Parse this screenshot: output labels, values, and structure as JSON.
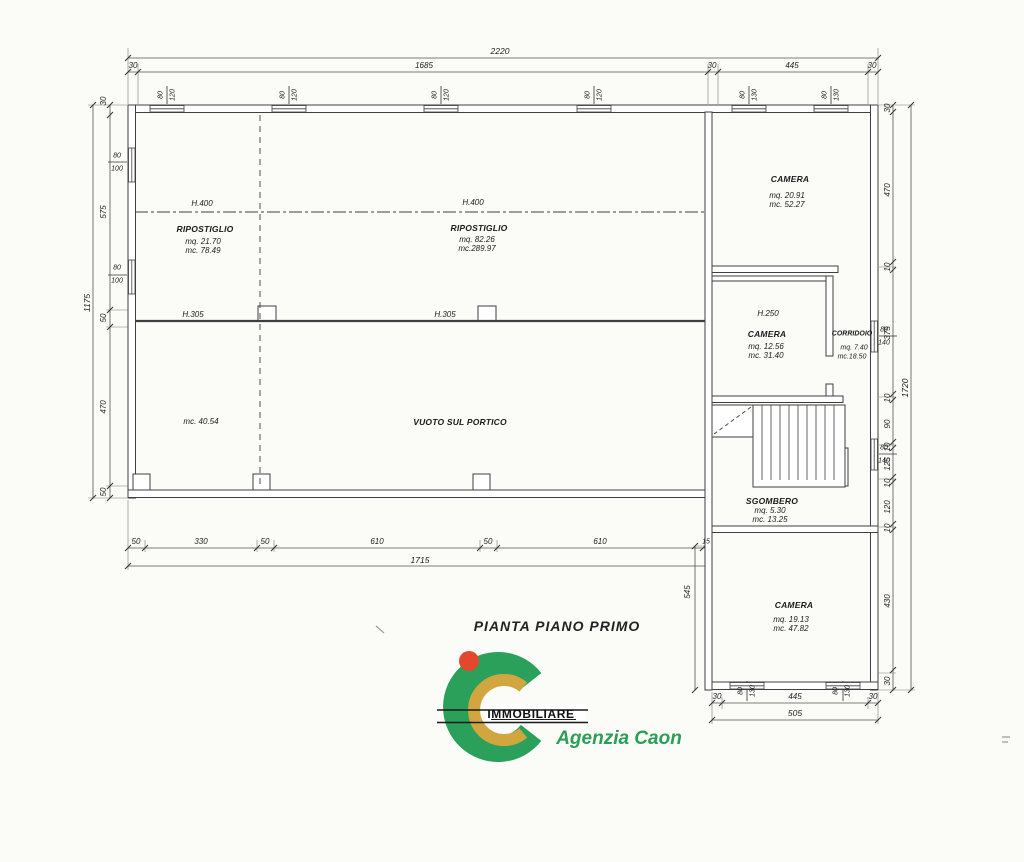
{
  "title": "PIANTA PIANO PRIMO",
  "logo": {
    "immobiliare": "IMMOBILIARE",
    "agenzia": "Agenzia Caon"
  },
  "rooms": {
    "ripostiglio_left": {
      "h": "H.400",
      "name": "RIPOSTIGLIO",
      "mq": "mq. 21.70",
      "mc": "mc. 78.49"
    },
    "ripostiglio_center": {
      "h": "H.400",
      "name": "RIPOSTIGLIO",
      "mq": "mq. 82.26",
      "mc": "mc.289.97"
    },
    "camera_top": {
      "name": "CAMERA",
      "mq": "mq. 20.91",
      "mc": "mc. 52.27"
    },
    "camera_mid": {
      "h": "H.250",
      "name": "CAMERA",
      "mq": "mq. 12.56",
      "mc": "mc. 31.40"
    },
    "corridoio": {
      "name": "CORRIDOIO",
      "mq": "mq. 7.40",
      "mc": "mc.18.50"
    },
    "sgombero": {
      "name": "SGOMBERO",
      "mq": "mq. 5.30",
      "mc": "mc. 13.25"
    },
    "camera_bottom": {
      "name": "CAMERA",
      "mq": "mq. 19.13",
      "mc": "mc. 47.82"
    },
    "vuoto": {
      "name": "VUOTO SUL PORTICO",
      "mc": "mc. 40.54"
    },
    "h305_left": "H.305",
    "h305_right": "H.305"
  },
  "dims": {
    "top": {
      "total": "2220",
      "segs": [
        "30",
        "1685",
        "30",
        "445",
        "30"
      ]
    },
    "left": {
      "total": "1175",
      "segs": [
        "30",
        "575",
        "50",
        "470",
        "50"
      ]
    },
    "right": {
      "total": "1720",
      "segs": [
        "30",
        "470",
        "10",
        "375",
        "10",
        "90",
        "10",
        "125",
        "10",
        "120",
        "10",
        "430",
        "30"
      ]
    },
    "bottom": {
      "total": "1715",
      "segs": [
        "50",
        "330",
        "50",
        "610",
        "50",
        "610",
        "15"
      ]
    },
    "wing_bottom": {
      "total": "505",
      "segs": [
        "30",
        "445",
        "30"
      ]
    },
    "wing_height": "545",
    "windows": {
      "t1": [
        "80",
        "120"
      ],
      "t2": [
        "80",
        "120"
      ],
      "t3": [
        "80",
        "120"
      ],
      "t4": [
        "80",
        "120"
      ],
      "t5": [
        "80",
        "130"
      ],
      "t6": [
        "80",
        "130"
      ],
      "l1": [
        "80",
        "100"
      ],
      "l2": [
        "80",
        "100"
      ],
      "r1": [
        "80",
        "140"
      ],
      "r2": [
        "80",
        "140"
      ],
      "b1": [
        "80",
        "130"
      ],
      "b2": [
        "80",
        "130"
      ]
    }
  }
}
